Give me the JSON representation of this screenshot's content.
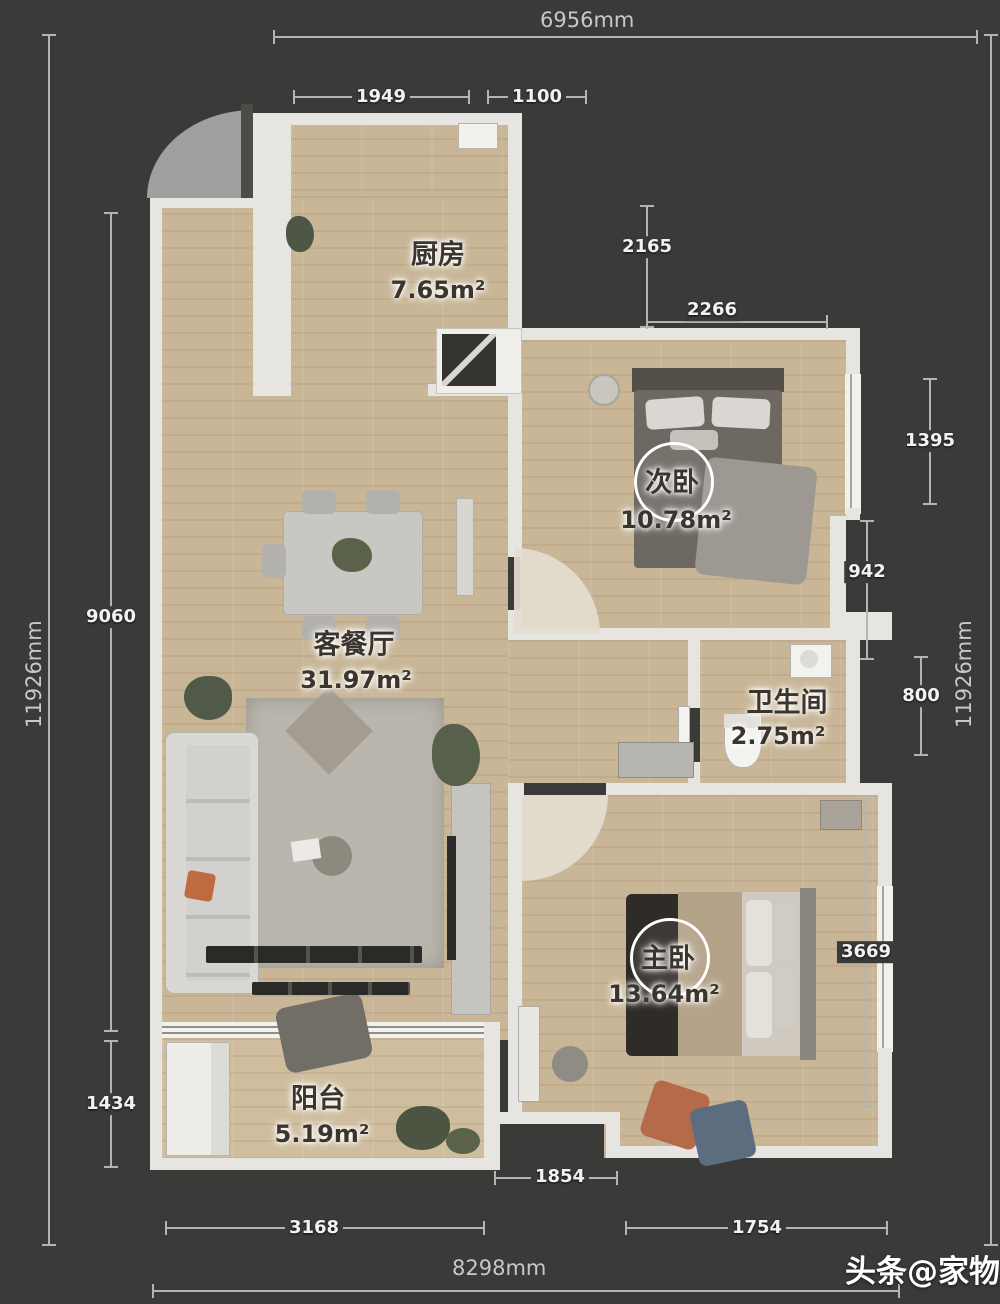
{
  "rooms": [
    {
      "id": "kitchen",
      "name": "厨房",
      "area": "7.65m²"
    },
    {
      "id": "second-bedroom",
      "name": "次卧",
      "area": "10.78m²"
    },
    {
      "id": "living-dining",
      "name": "客餐厅",
      "area": "31.97m²"
    },
    {
      "id": "bathroom",
      "name": "卫生间",
      "area": "2.75m²"
    },
    {
      "id": "master-bedroom",
      "name": "主卧",
      "area": "13.64m²"
    },
    {
      "id": "balcony",
      "name": "阳台",
      "area": "5.19m²"
    }
  ],
  "dims": {
    "top_total": "6956mm",
    "seg_1949": "1949",
    "seg_1100": "1100",
    "seg_2165": "2165",
    "seg_2266": "2266",
    "seg_1395": "1395",
    "seg_942": "942",
    "seg_800": "800",
    "seg_3669": "3669",
    "right_total": "11926mm",
    "left_total": "11926mm",
    "seg_9060": "9060",
    "seg_1434": "1434",
    "seg_3168": "3168",
    "seg_1854": "1854",
    "seg_1754": "1754",
    "bottom_total": "8298mm"
  },
  "watermark": "头条@家物"
}
